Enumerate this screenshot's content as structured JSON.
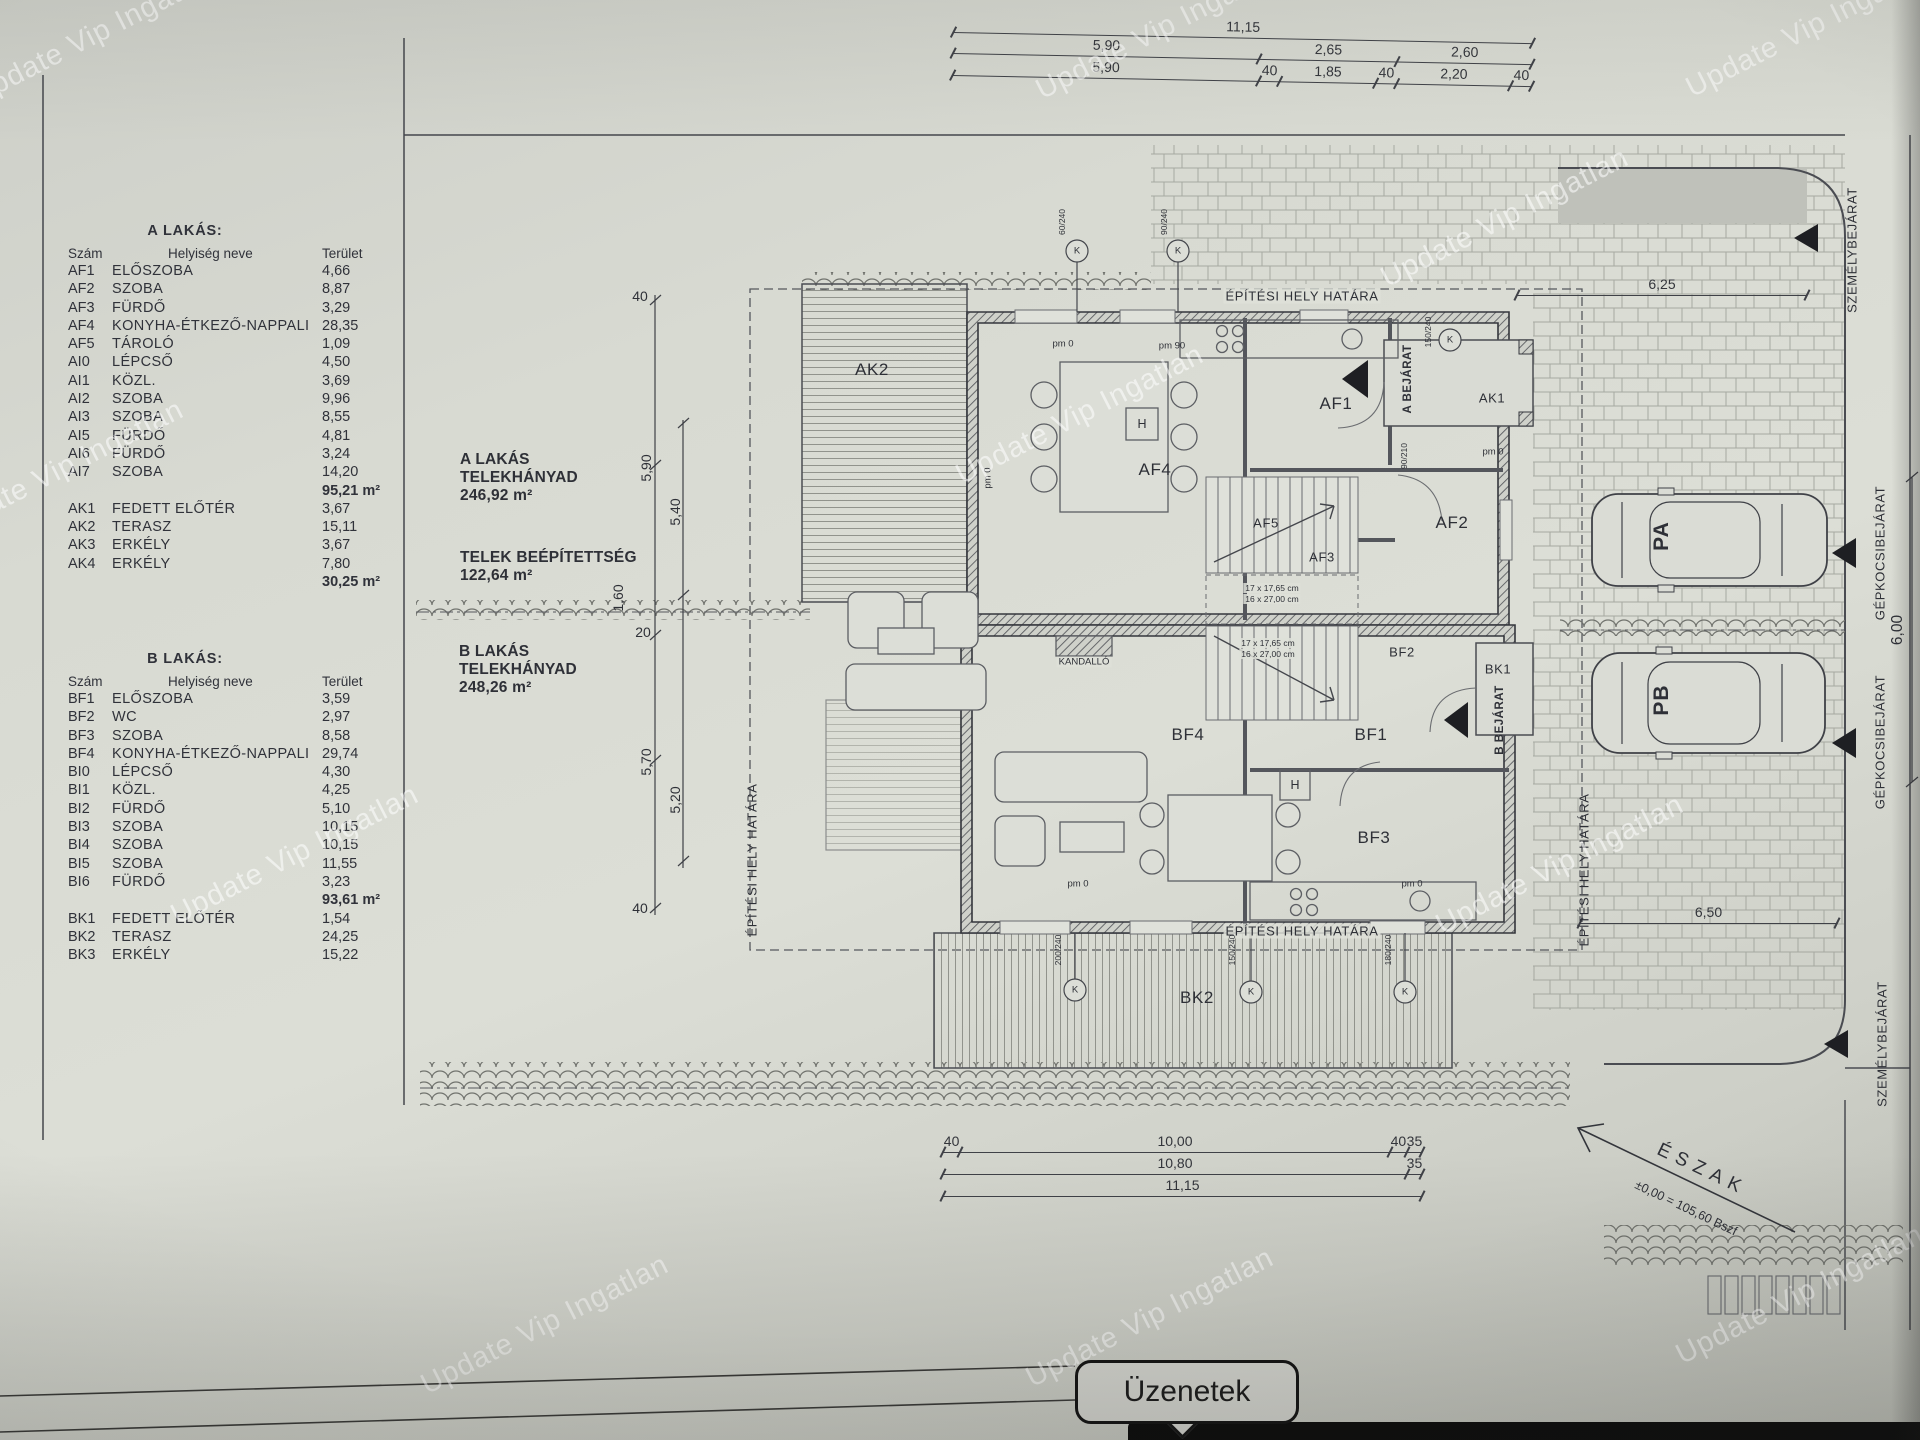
{
  "watermark": {
    "text": "Update Vip Ingatlan"
  },
  "tables": {
    "a": {
      "title": "A LAKÁS:",
      "col_num": "Szám",
      "col_name": "Helyiség neve",
      "col_area": "Terület",
      "rooms": [
        [
          "AF1",
          "ELŐSZOBA",
          "4,66"
        ],
        [
          "AF2",
          "SZOBA",
          "8,87"
        ],
        [
          "AF3",
          "FÜRDŐ",
          "3,29"
        ],
        [
          "AF4",
          "KONYHA-ÉTKEZŐ-NAPPALI",
          "28,35"
        ],
        [
          "AF5",
          "TÁROLÓ",
          "1,09"
        ],
        [
          "AI0",
          "LÉPCSŐ",
          "4,50"
        ],
        [
          "AI1",
          "KÖZL.",
          "3,69"
        ],
        [
          "AI2",
          "SZOBA",
          "9,96"
        ],
        [
          "AI3",
          "SZOBA",
          "8,55"
        ],
        [
          "AI5",
          "FÜRDŐ",
          "4,81"
        ],
        [
          "AI6",
          "FÜRDŐ",
          "3,24"
        ],
        [
          "AI7",
          "SZOBA",
          "14,20"
        ]
      ],
      "subtotal": "95,21 m²",
      "outdoor": [
        [
          "AK1",
          "FEDETT ELŐTÉR",
          "3,67"
        ],
        [
          "AK2",
          "TERASZ",
          "15,11"
        ],
        [
          "AK3",
          "ERKÉLY",
          "3,67"
        ],
        [
          "AK4",
          "ERKÉLY",
          "7,80"
        ]
      ],
      "outdoor_total": "30,25 m²"
    },
    "b": {
      "title": "B LAKÁS:",
      "col_num": "Szám",
      "col_name": "Helyiség neve",
      "col_area": "Terület",
      "rooms": [
        [
          "BF1",
          "ELŐSZOBA",
          "3,59"
        ],
        [
          "BF2",
          "WC",
          "2,97"
        ],
        [
          "BF3",
          "SZOBA",
          "8,58"
        ],
        [
          "BF4",
          "KONYHA-ÉTKEZŐ-NAPPALI",
          "29,74"
        ],
        [
          "BI0",
          "LÉPCSŐ",
          "4,30"
        ],
        [
          "BI1",
          "KÖZL.",
          "4,25"
        ],
        [
          "BI2",
          "FÜRDŐ",
          "5,10"
        ],
        [
          "BI3",
          "SZOBA",
          "10,15"
        ],
        [
          "BI4",
          "SZOBA",
          "10,15"
        ],
        [
          "BI5",
          "SZOBA",
          "11,55"
        ],
        [
          "BI6",
          "FÜRDŐ",
          "3,23"
        ]
      ],
      "subtotal": "93,61 m²",
      "outdoor": [
        [
          "BK1",
          "FEDETT ELŐTÉR",
          "1,54"
        ],
        [
          "BK2",
          "TERASZ",
          "24,25"
        ],
        [
          "BK3",
          "ERKÉLY",
          "15,22"
        ]
      ],
      "outdoor_total": ""
    }
  },
  "site_info": {
    "a1": "A LAKÁS",
    "a2": "TELEKHÁNYAD",
    "a3": "246,92 m²",
    "t1": "TELEK BEÉPÍTETTSÉG",
    "t2": "122,64 m²",
    "b1": "B LAKÁS",
    "b2": "TELEKHÁNYAD",
    "b3": "248,26 m²"
  },
  "dims": {
    "top_rows": [
      [
        {
          "t": "11,15",
          "w": 11.15
        }
      ],
      [
        {
          "t": "5,90",
          "w": 5.9
        },
        {
          "t": "2,65",
          "w": 2.65
        },
        {
          "t": "2,60",
          "w": 2.6
        }
      ],
      [
        {
          "t": "5,90",
          "w": 5.9
        },
        {
          "t": "40",
          "w": 0.4
        },
        {
          "t": "1,85",
          "w": 1.85
        },
        {
          "t": "40",
          "w": 0.4
        },
        {
          "t": "2,20",
          "w": 2.2
        },
        {
          "t": "40",
          "w": 0.4
        }
      ]
    ],
    "bottom_rows": [
      [
        {
          "t": "40",
          "w": 0.4
        },
        {
          "t": "10,00",
          "w": 10.0
        },
        {
          "t": "40",
          "w": 0.4
        },
        {
          "t": "35",
          "w": 0.35
        }
      ],
      [
        {
          "t": "10,80",
          "w": 10.8
        },
        {
          "t": "35",
          "w": 0.35
        }
      ],
      [
        {
          "t": "11,15",
          "w": 11.15
        }
      ]
    ],
    "right_625": [
      [
        {
          "t": "6,25",
          "w": 6.25
        }
      ]
    ],
    "right_650": [
      [
        {
          "t": "6,50",
          "w": 6.5
        }
      ]
    ],
    "d600": "6,00",
    "left": [
      "40",
      "5,90",
      "5,40",
      "20",
      "1,60",
      "5,70",
      "5,20",
      "40"
    ]
  },
  "entries": {
    "szemely": "SZEMÉLYBEJÁRAT",
    "gepkocsi": "GÉPKOCSIBEJÁRAT"
  },
  "north": {
    "label": "ÉSZAK",
    "elevation": "±0,00 = 105,60 Bszf"
  },
  "plan": {
    "boundary": "ÉPÍTÉSI HELY HATÁRA",
    "labels": {
      "ak2": "AK2",
      "af4": "AF4",
      "af1": "AF1",
      "af2": "AF2",
      "af3": "AF3",
      "af5": "AF5",
      "ak1": "AK1",
      "bf4": "BF4",
      "bf1": "BF1",
      "bf2": "BF2",
      "bf3": "BF3",
      "bk1": "BK1",
      "bk2": "BK2",
      "kandallo": "KANDALLÓ",
      "pa": "PA",
      "pb": "PB",
      "h": "H",
      "k": "K",
      "a_bejarat": "A BEJÁRAT",
      "b_bejarat": "B BEJÁRAT"
    },
    "annotations": {
      "pm0": "pm 0",
      "pm90": "pm 90",
      "stair1": "17 x 17,65 cm",
      "stair2": "16 x 27,00 cm",
      "d60": "60/240",
      "d90": "90/240",
      "d150": "150/240",
      "d90210": "90/210",
      "d200": "200/240",
      "d150b": "150/240",
      "d180": "180/240"
    }
  },
  "ui": {
    "messages": "Üzenetek"
  }
}
